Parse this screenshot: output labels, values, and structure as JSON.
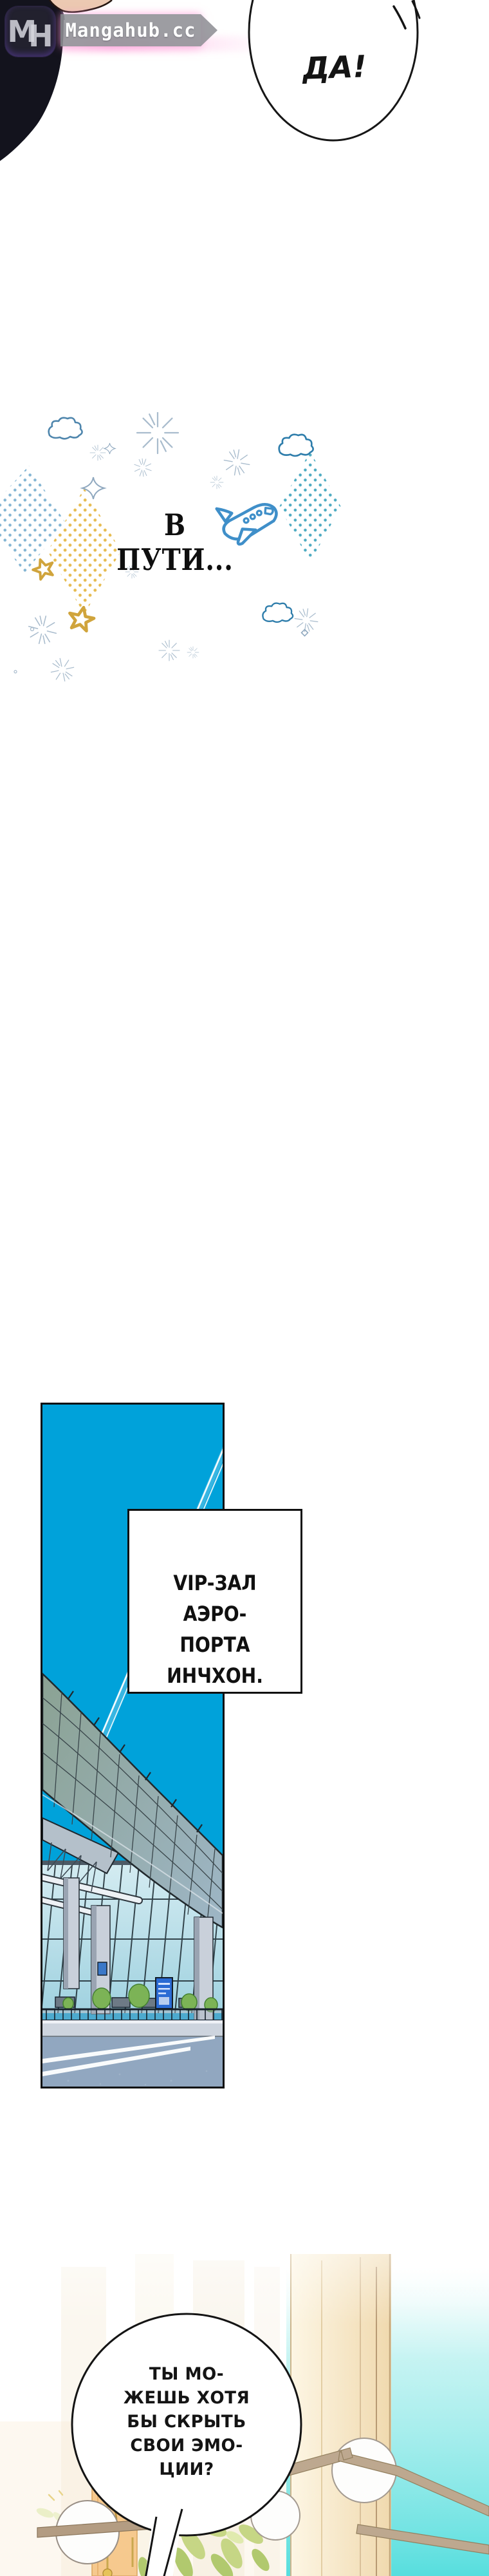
{
  "watermark": {
    "logo_text": "MH",
    "logo_letter_1": "M",
    "logo_letter_2": "H",
    "site_name": "Mangahub.cc"
  },
  "top_panel": {
    "bubble_text": "ДА!"
  },
  "transition": {
    "title": "В ПУТИ..."
  },
  "airport_panel": {
    "caption_lines": [
      "VIP-ЗАЛ АЭРО-",
      "ПОРТА ИНЧХОН."
    ]
  },
  "bottom_panel": {
    "bubble_lines": [
      "ТЫ МО-",
      "ЖЕШЬ ХОТЯ",
      "БЫ СКРЫТЬ",
      "СВОИ ЭМО-",
      "ЦИИ?"
    ]
  },
  "icons": {
    "logo": "mh-logo-icon",
    "plane": "plane-doodle-icon",
    "cloud": "cloud-doodle-icon",
    "star": "star-doodle-icon",
    "sparkle": "sparkle-doodle-icon",
    "lamp": "sphere-lamp-icon",
    "plant": "plant-leaves-icon"
  },
  "colors": {
    "sky": "#00a2da",
    "plane": "#3f8fc9",
    "cloud": "#357fae",
    "dots-blue": "#6fa8cc",
    "dots-yellow": "#e5b53e",
    "dots-teal": "#2f9db8",
    "star-yellow": "#d0a43c",
    "teal-window": "#57dede",
    "beam-tan": "#bda88f",
    "canopy-green": "#8ba293",
    "canopy-blue": "#9eb6c6",
    "glass": "#bfe2ea",
    "road": "#91a7c0",
    "bush": "#7cb356",
    "sign-blue": "#2b6bd4",
    "ink": "#111111"
  }
}
